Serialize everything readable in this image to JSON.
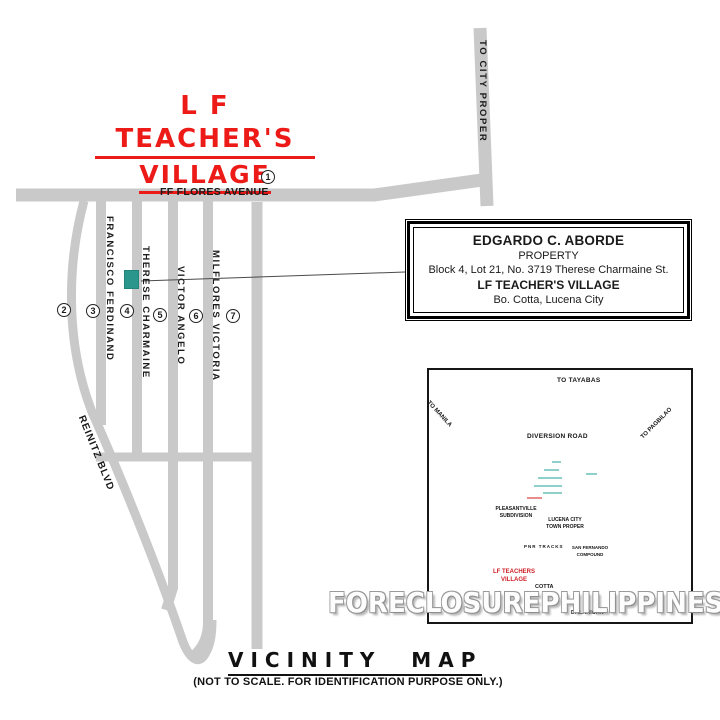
{
  "title": {
    "line1": "L F  TEACHER'S",
    "line2": "VILLAGE"
  },
  "colors": {
    "road_gray": "#c9c9c9",
    "title_red": "#ed1b18",
    "marker_teal": "#2a968c",
    "dot_red": "#de1f1f",
    "inset_label_red": "#cf2028"
  },
  "main_map": {
    "avenue_label": "FF FLORES AVENUE",
    "to_city_proper": "TO CITY PROPER",
    "reinitz": "REINITZ BLVD",
    "streets": [
      "FRANCISCO FERDINAND",
      "THERESE CHARMAINE",
      "VICTOR ANGELO",
      "MILFLORES VICTORIA"
    ],
    "markers": [
      "1",
      "2",
      "3",
      "4",
      "5",
      "6",
      "7"
    ]
  },
  "info_box": {
    "owner": "EDGARDO C. ABORDE",
    "property": "PROPERTY",
    "address": "Block 4, Lot 21, No. 3719 Therese Charmaine St.",
    "village": "LF TEACHER'S VILLAGE",
    "city": "Bo. Cotta, Lucena City"
  },
  "inset": {
    "to_tayabas": "TO TAYABAS",
    "diversion_road": "DIVERSION ROAD",
    "to_manila": "TO MANILA",
    "to_pagbilao": "TO PAGBILAO",
    "pleasantville_l1": "PLEASANTVILLE",
    "pleasantville_l2": "SUBDIVISION",
    "lucena_l1": "LUCENA CITY",
    "lucena_l2": "TOWN PROPER",
    "pnr_tracks": "PNR TRACKS",
    "san_fernando_l1": "SAN FERNANDO",
    "san_fernando_l2": "COMPOUND",
    "lf_l1": "LF TEACHERS",
    "lf_l2": "VILLAGE",
    "cotta": "COTTA",
    "dalahican": "DALAHICAN"
  },
  "watermark": "FORECLOSUREPHILIPPINES.COM",
  "footer": {
    "title": "VICINITY MAP",
    "note": "(NOT TO SCALE. FOR IDENTIFICATION PURPOSE ONLY.)"
  }
}
